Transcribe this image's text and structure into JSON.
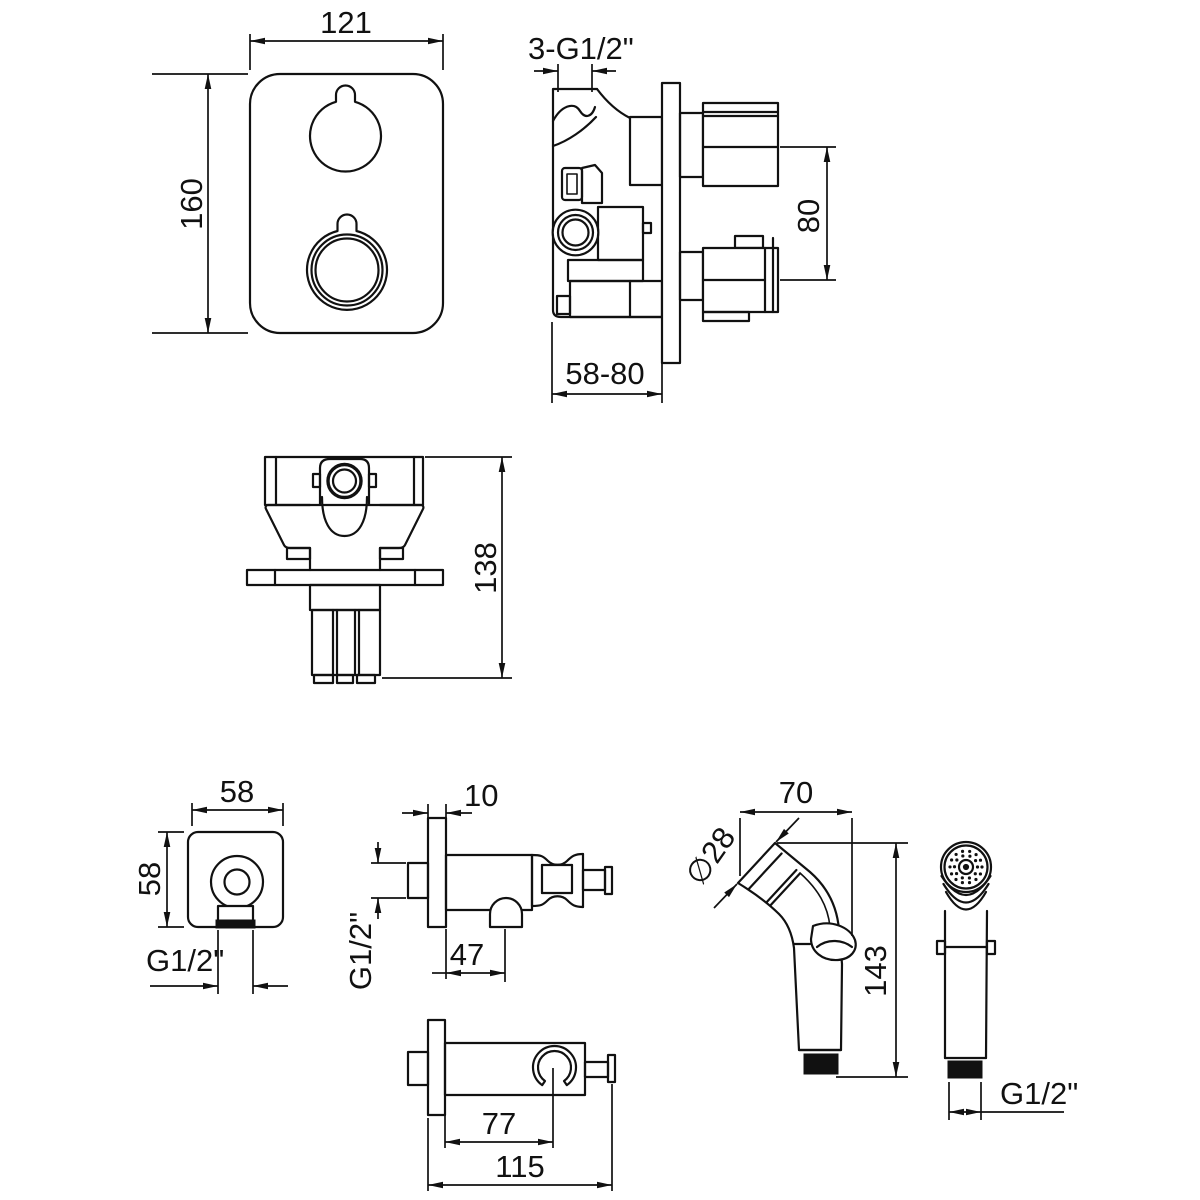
{
  "views": {
    "front_plate": {
      "width_label": "121",
      "height_label": "160"
    },
    "valve_side": {
      "thread_label": "3-G1/2\"",
      "knob_spacing_label": "80",
      "depth_range_label": "58-80"
    },
    "valve_top": {
      "height_label": "138"
    },
    "outlet_front": {
      "width_label": "58",
      "height_label": "58",
      "thread_label": "G1/2\""
    },
    "outlet_side": {
      "plate_thickness_label": "10",
      "thread_label": "G1/2\"",
      "outlet_offset_label": "47"
    },
    "outlet_bottom": {
      "holder_offset_label": "77",
      "overall_length_label": "115"
    },
    "sprayer_side": {
      "head_width_label": "70",
      "head_diameter_label": "∅28",
      "height_label": "143"
    },
    "sprayer_front": {
      "thread_label": "G1/2\""
    }
  },
  "colors": {
    "line": "#111111",
    "background": "#ffffff"
  }
}
